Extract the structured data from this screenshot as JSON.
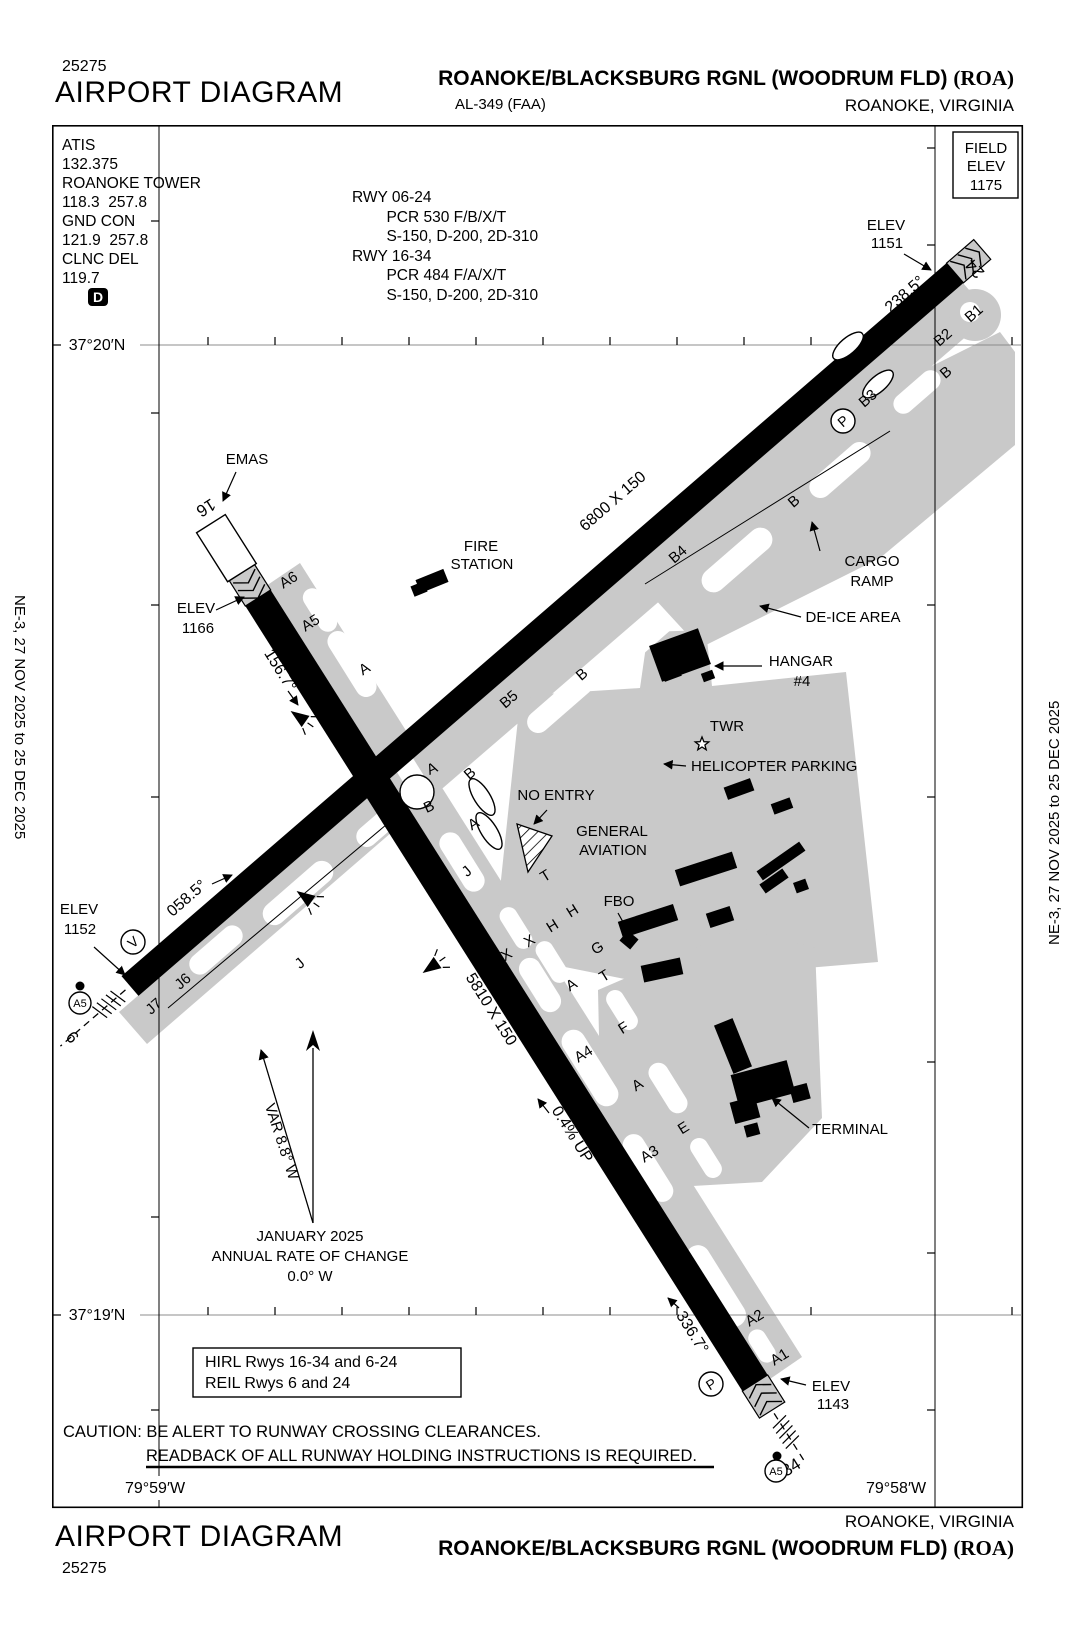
{
  "colors": {
    "taxiway": "#c9c9c9",
    "runway": "#000000",
    "grid": "#8c8c8c",
    "paper": "#ffffff"
  },
  "edition": {
    "left": "NE-3,  27 NOV 2025  to  25 DEC 2025",
    "right": "NE-3,  27 NOV 2025  to  25 DEC 2025"
  },
  "header": {
    "chart_no": "25275",
    "title": "AIRPORT DIAGRAM",
    "airport_main": "ROANOKE/BLACKSBURG RGNL (WOODRUM FLD)",
    "airport_code": "(ROA)",
    "al": "AL-349 (FAA)",
    "city": "ROANOKE, VIRGINIA"
  },
  "footer": {
    "title": "AIRPORT DIAGRAM",
    "chart_no": "25275",
    "city": "ROANOKE, VIRGINIA",
    "airport_main": "ROANOKE/BLACKSBURG RGNL (WOODRUM FLD)",
    "airport_code": "(ROA)"
  },
  "comm": {
    "lines": [
      "ATIS",
      "132.375",
      "ROANOKE TOWER",
      "118.3  257.8",
      "GND CON",
      "121.9  257.8",
      "CLNC DEL",
      "119.7"
    ],
    "delivery_badge": "D"
  },
  "runway_info": {
    "lines": [
      "RWY 06-24",
      "        PCR 530 F/B/X/T",
      "        S-150, D-200, 2D-310",
      "RWY 16-34",
      "        PCR 484 F/A/X/T",
      "        S-150, D-200, 2D-310"
    ]
  },
  "map": {
    "labels": [
      {
        "t": "FIELD",
        "x": 986,
        "y": 153
      },
      {
        "t": "ELEV",
        "x": 986,
        "y": 171
      },
      {
        "t": "1175",
        "x": 986,
        "y": 190
      },
      {
        "t": "37°20′N",
        "x": 97,
        "y": 350,
        "s": 16
      },
      {
        "t": "37°19′N",
        "x": 97,
        "y": 1320,
        "s": 16
      },
      {
        "t": "79°59′W",
        "x": 155,
        "y": 1493,
        "s": 16
      },
      {
        "t": "79°58′W",
        "x": 896,
        "y": 1493,
        "s": 16
      },
      {
        "t": "EMAS",
        "x": 247,
        "y": 464
      },
      {
        "t": "ELEV",
        "x": 196,
        "y": 613
      },
      {
        "t": "1166",
        "x": 198,
        "y": 633
      },
      {
        "t": "FIRE",
        "x": 481,
        "y": 551
      },
      {
        "t": "STATION",
        "x": 482,
        "y": 569
      },
      {
        "t": "CARGO",
        "x": 872,
        "y": 566
      },
      {
        "t": "RAMP",
        "x": 872,
        "y": 586
      },
      {
        "t": "DE-ICE AREA",
        "x": 853,
        "y": 622
      },
      {
        "t": "HANGAR",
        "x": 801,
        "y": 666
      },
      {
        "t": "#4",
        "x": 802,
        "y": 686
      },
      {
        "t": "TWR",
        "x": 727,
        "y": 731
      },
      {
        "t": "HELICOPTER PARKING",
        "x": 691,
        "y": 771,
        "a": "start"
      },
      {
        "t": "NO ENTRY",
        "x": 556,
        "y": 800
      },
      {
        "t": "GENERAL",
        "x": 612,
        "y": 836
      },
      {
        "t": "AVIATION",
        "x": 613,
        "y": 855
      },
      {
        "t": "FBO",
        "x": 619,
        "y": 906
      },
      {
        "t": "TERMINAL",
        "x": 850,
        "y": 1134
      },
      {
        "t": "ELEV",
        "x": 886,
        "y": 230
      },
      {
        "t": "1151",
        "x": 887,
        "y": 248
      },
      {
        "t": "ELEV",
        "x": 79,
        "y": 914
      },
      {
        "t": "1152",
        "x": 80,
        "y": 934
      },
      {
        "t": "ELEV",
        "x": 831,
        "y": 1391
      },
      {
        "t": "1143",
        "x": 833,
        "y": 1409
      },
      {
        "t": "JANUARY 2025",
        "x": 310,
        "y": 1241
      },
      {
        "t": "ANNUAL RATE OF CHANGE",
        "x": 310,
        "y": 1261
      },
      {
        "t": "0.0° W",
        "x": 310,
        "y": 1281
      },
      {
        "t": "VAR 8.8° W",
        "x": 277,
        "y": 1143,
        "r": 72
      },
      {
        "t": "6800 X 150",
        "x": 616,
        "y": 505,
        "r": -41,
        "s": 16
      },
      {
        "t": "5810 X 150",
        "x": 487,
        "y": 1012,
        "r": 58,
        "s": 16
      },
      {
        "t": "238.5°",
        "x": 908,
        "y": 298,
        "r": -41,
        "s": 16
      },
      {
        "t": "058.5°",
        "x": 190,
        "y": 902,
        "r": -41,
        "s": 16
      },
      {
        "t": "156.7°",
        "x": 276,
        "y": 673,
        "r": 58,
        "s": 16
      },
      {
        "t": "336.7°",
        "x": 688,
        "y": 1335,
        "r": 58,
        "s": 16
      },
      {
        "t": "0.4% UP",
        "x": 568,
        "y": 1137,
        "r": 58,
        "s": 16
      },
      {
        "t": "24",
        "x": 979,
        "y": 265,
        "r": 229,
        "s": 17
      },
      {
        "t": "16",
        "x": 203,
        "y": 503,
        "r": 148,
        "s": 17
      },
      {
        "t": "6",
        "x": 68,
        "y": 1041,
        "r": 49,
        "s": 17
      },
      {
        "t": "34",
        "x": 794,
        "y": 1472,
        "r": -32,
        "s": 17
      },
      {
        "t": "A6",
        "x": 291,
        "y": 584,
        "r": -32
      },
      {
        "t": "A5",
        "x": 313,
        "y": 627,
        "r": -32
      },
      {
        "t": "A",
        "x": 367,
        "y": 673,
        "r": -32
      },
      {
        "t": "B5",
        "x": 512,
        "y": 703,
        "r": -41
      },
      {
        "t": "B",
        "x": 585,
        "y": 678,
        "r": -41
      },
      {
        "t": "B4",
        "x": 681,
        "y": 558,
        "r": -41
      },
      {
        "t": "B",
        "x": 797,
        "y": 505,
        "r": -41
      },
      {
        "t": "B3",
        "x": 871,
        "y": 402,
        "r": -41
      },
      {
        "t": "B",
        "x": 949,
        "y": 376,
        "r": -41
      },
      {
        "t": "B2",
        "x": 946,
        "y": 341,
        "r": -41
      },
      {
        "t": "B1",
        "x": 977,
        "y": 317,
        "r": -41
      },
      {
        "t": "A",
        "x": 434,
        "y": 773,
        "r": -25
      },
      {
        "t": "B",
        "x": 431,
        "y": 811,
        "r": -25
      },
      {
        "t": "B",
        "x": 473,
        "y": 777,
        "r": -41
      },
      {
        "t": "A",
        "x": 476,
        "y": 828,
        "r": -32
      },
      {
        "t": "T",
        "x": 548,
        "y": 880,
        "r": -32
      },
      {
        "t": "H",
        "x": 575,
        "y": 915,
        "r": -32
      },
      {
        "t": "H",
        "x": 555,
        "y": 930,
        "r": -32
      },
      {
        "t": "X",
        "x": 532,
        "y": 945,
        "r": -32
      },
      {
        "t": "X",
        "x": 509,
        "y": 959,
        "r": -32
      },
      {
        "t": "G",
        "x": 600,
        "y": 952,
        "r": -32
      },
      {
        "t": "T",
        "x": 607,
        "y": 980,
        "r": -32
      },
      {
        "t": "A",
        "x": 574,
        "y": 989,
        "r": -32
      },
      {
        "t": "F",
        "x": 626,
        "y": 1032,
        "r": -32
      },
      {
        "t": "A4",
        "x": 586,
        "y": 1058,
        "r": -32
      },
      {
        "t": "A",
        "x": 640,
        "y": 1089,
        "r": -32
      },
      {
        "t": "E",
        "x": 686,
        "y": 1132,
        "r": -32
      },
      {
        "t": "A3",
        "x": 652,
        "y": 1158,
        "r": -32
      },
      {
        "t": "A2",
        "x": 757,
        "y": 1322,
        "r": -32
      },
      {
        "t": "A1",
        "x": 782,
        "y": 1361,
        "r": -32
      },
      {
        "t": "J",
        "x": 303,
        "y": 967,
        "r": -41
      },
      {
        "t": "J",
        "x": 470,
        "y": 875,
        "r": -41
      },
      {
        "t": "J6",
        "x": 186,
        "y": 985,
        "r": -41
      },
      {
        "t": "J7",
        "x": 157,
        "y": 1010,
        "r": -41
      },
      {
        "t": "HIRL Rwys 16-34 and 6-24",
        "x": 205,
        "y": 1367,
        "a": "start",
        "s": 16
      },
      {
        "t": "REIL Rwys 6 and 24",
        "x": 205,
        "y": 1388,
        "a": "start",
        "s": 16
      },
      {
        "t": "CAUTION: BE ALERT TO RUNWAY CROSSING CLEARANCES.",
        "x": 63,
        "y": 1437,
        "a": "start",
        "s": 16.5
      },
      {
        "t": "READBACK OF ALL RUNWAY HOLDING INSTRUCTIONS IS REQUIRED.",
        "x": 146,
        "y": 1461,
        "a": "start",
        "s": 16.5
      }
    ],
    "circled": [
      {
        "t": "P",
        "x": 843,
        "y": 421,
        "r": -41
      },
      {
        "t": "P",
        "x": 711,
        "y": 1384,
        "r": -32
      },
      {
        "t": "V",
        "x": 133,
        "y": 942,
        "r": -41
      },
      {
        "t": "A5",
        "x": 80,
        "y": 1003,
        "cr": 11,
        "s": 11
      },
      {
        "t": "A5",
        "x": 776,
        "y": 1471,
        "cr": 11,
        "s": 11
      }
    ],
    "dots": [
      {
        "x": 80,
        "y": 986
      },
      {
        "x": 777,
        "y": 1456
      }
    ]
  }
}
